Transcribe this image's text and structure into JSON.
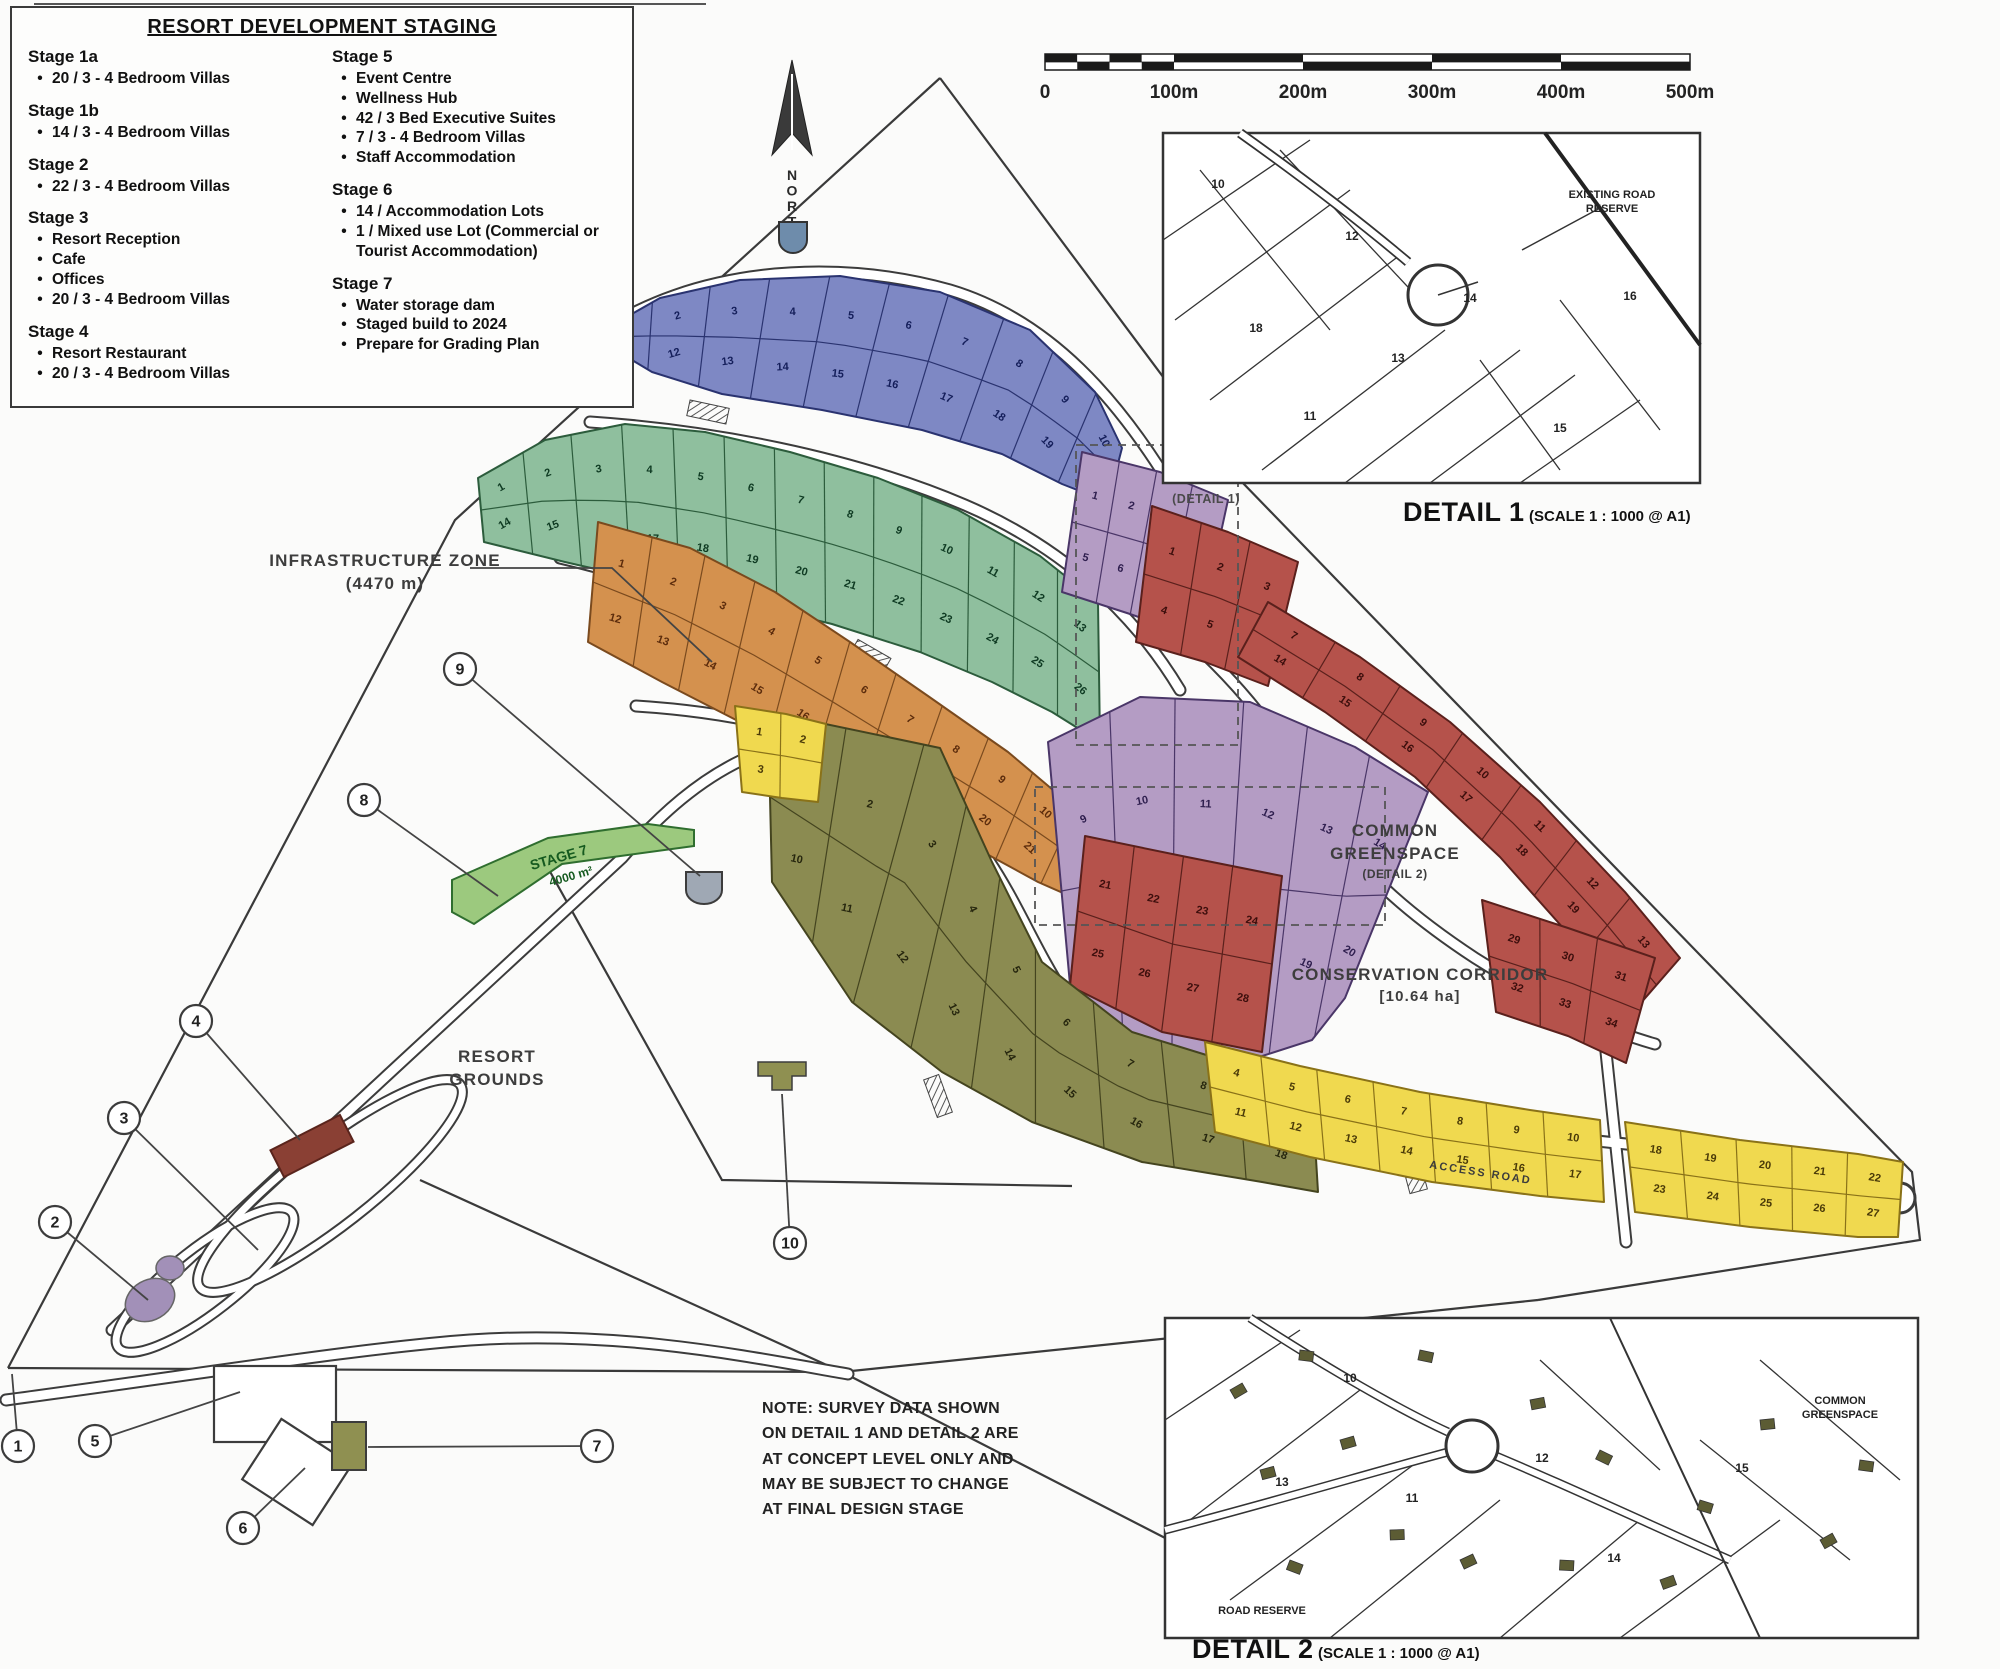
{
  "legend": {
    "title": "RESORT DEVELOPMENT STAGING",
    "columns": [
      [
        {
          "name": "Stage 1a",
          "items": [
            "20 / 3 - 4 Bedroom Villas"
          ]
        },
        {
          "name": "Stage 1b",
          "items": [
            "14 / 3 - 4 Bedroom Villas"
          ]
        },
        {
          "name": "Stage 2",
          "items": [
            "22 / 3 - 4 Bedroom Villas"
          ]
        },
        {
          "name": "Stage 3",
          "items": [
            "Resort Reception",
            "Cafe",
            "Offices",
            "20 / 3 - 4 Bedroom Villas"
          ]
        },
        {
          "name": "Stage 4",
          "items": [
            "Resort Restaurant",
            "20 / 3 - 4 Bedroom Villas"
          ]
        }
      ],
      [
        {
          "name": "Stage 5",
          "items": [
            "Event Centre",
            "Wellness Hub",
            "42 / 3 Bed Executive Suites",
            "7 / 3 - 4 Bedroom Villas",
            "Staff Accommodation"
          ]
        },
        {
          "name": "Stage 6",
          "items": [
            "14 / Accommodation Lots",
            "1 / Mixed use Lot (Commercial or Tourist Accommodation)"
          ]
        },
        {
          "name": "Stage 7",
          "items": [
            "Water storage dam",
            "Staged build to 2024",
            "Prepare for Grading Plan"
          ]
        }
      ]
    ]
  },
  "north": {
    "label": "NORTH"
  },
  "scale_bar": {
    "labels": [
      "0",
      "100m",
      "200m",
      "300m",
      "400m",
      "500m"
    ]
  },
  "map_labels": {
    "infrastructure": {
      "line1": "INFRASTRUCTURE ZONE",
      "line2": "(4470 m)"
    },
    "resort_grounds": {
      "line1": "RESORT",
      "line2": "GROUNDS"
    },
    "common_greenspace": {
      "line1": "COMMON",
      "line2": "GREENSPACE",
      "tag": "(DETAIL 2)"
    },
    "conservation": {
      "line1": "CONSERVATION CORRIDOR",
      "line2": "[10.64 ha]"
    },
    "detail1_tag": "(DETAIL 1)",
    "stage7_strip": {
      "line1": "STAGE 7",
      "line2": "4000 m²"
    },
    "road_name": "ACCESS ROAD"
  },
  "note": {
    "lines": [
      "NOTE: SURVEY DATA SHOWN",
      "ON DETAIL 1 AND DETAIL 2 ARE",
      "AT CONCEPT LEVEL ONLY AND",
      "MAY BE SUBJECT TO CHANGE",
      "AT FINAL DESIGN STAGE"
    ]
  },
  "details": {
    "d1": {
      "caption": "DETAIL 1",
      "scale": "(SCALE 1 : 1000 @ A1)",
      "pointer": {
        "line1": "EXISTING ROAD",
        "line2": "RESERVE"
      },
      "lot_numbers": [
        "10",
        "11",
        "12",
        "13",
        "14",
        "15",
        "16",
        "18"
      ]
    },
    "d2": {
      "caption": "DETAIL 2",
      "scale": "(SCALE 1 : 1000 @ A1)",
      "right_label": {
        "line1": "COMMON",
        "line2": "GREENSPACE"
      },
      "bottom_label": "ROAD RESERVE",
      "lot_numbers": [
        "10",
        "11",
        "12",
        "13",
        "14",
        "15"
      ]
    }
  },
  "callouts": [
    {
      "n": "1",
      "cx": 18,
      "cy": 1446,
      "lx": 12,
      "ly": 1374
    },
    {
      "n": "2",
      "cx": 55,
      "cy": 1222,
      "lx": 148,
      "ly": 1300
    },
    {
      "n": "3",
      "cx": 124,
      "cy": 1118,
      "lx": 258,
      "ly": 1250
    },
    {
      "n": "4",
      "cx": 196,
      "cy": 1021,
      "lx": 300,
      "ly": 1140
    },
    {
      "n": "5",
      "cx": 95,
      "cy": 1441,
      "lx": 240,
      "ly": 1392
    },
    {
      "n": "6",
      "cx": 243,
      "cy": 1528,
      "lx": 305,
      "ly": 1468
    },
    {
      "n": "7",
      "cx": 597,
      "cy": 1446,
      "lx": 368,
      "ly": 1447
    },
    {
      "n": "8",
      "cx": 364,
      "cy": 800,
      "lx": 498,
      "ly": 896
    },
    {
      "n": "9",
      "cx": 460,
      "cy": 669,
      "lx": 700,
      "ly": 876
    },
    {
      "n": "10",
      "cx": 790,
      "cy": 1243,
      "lx": 782,
      "ly": 1094
    }
  ],
  "clusters": [
    {
      "id": "blue",
      "color": "#7e88c4",
      "stroke": "#2a3370",
      "num": "#141e5a",
      "lots": [
        "1",
        "2",
        "3",
        "4",
        "5",
        "6",
        "7",
        "8",
        "9",
        "10",
        "11",
        "12",
        "13",
        "14",
        "15",
        "16",
        "17",
        "18",
        "19",
        "20"
      ]
    },
    {
      "id": "green",
      "color": "#8fbf9e",
      "stroke": "#2c5c3c",
      "num": "#0e3a22",
      "lots": [
        "1",
        "2",
        "3",
        "4",
        "5",
        "6",
        "7",
        "8",
        "9",
        "10",
        "11",
        "12",
        "13",
        "14",
        "15",
        "16",
        "17",
        "18",
        "19",
        "20",
        "21",
        "22",
        "23",
        "24",
        "25",
        "26"
      ]
    },
    {
      "id": "orange",
      "color": "#d4914e",
      "stroke": "#7a4a1e",
      "num": "#5c2c0c",
      "lots": [
        "1",
        "2",
        "3",
        "4",
        "5",
        "6",
        "7",
        "8",
        "9",
        "10",
        "11",
        "12",
        "13",
        "14",
        "15",
        "16",
        "17",
        "18",
        "19",
        "20",
        "21",
        "22"
      ]
    },
    {
      "id": "purple_a",
      "color": "#b49cc4",
      "stroke": "#4a3668",
      "num": "#2e1e4e",
      "lots": [
        "1",
        "2",
        "3",
        "4",
        "5",
        "6",
        "7",
        "8"
      ]
    },
    {
      "id": "purple_b",
      "color": "#b49cc4",
      "stroke": "#4a3668",
      "num": "#2e1e4e",
      "lots": [
        "9",
        "10",
        "11",
        "12",
        "13",
        "14",
        "15",
        "16",
        "17",
        "18",
        "19",
        "20"
      ]
    },
    {
      "id": "red_head",
      "color": "#b5524b",
      "stroke": "#5a201c",
      "num": "#3c0e0c",
      "lots": [
        "1",
        "2",
        "3",
        "4",
        "5",
        "6"
      ]
    },
    {
      "id": "red_band",
      "color": "#b5524b",
      "stroke": "#5a201c",
      "num": "#3c0e0c",
      "lots": [
        "7",
        "8",
        "9",
        "10",
        "11",
        "12",
        "13",
        "14",
        "15",
        "16",
        "17",
        "18",
        "19",
        "20"
      ]
    },
    {
      "id": "red_low",
      "color": "#b5524b",
      "stroke": "#5a201c",
      "num": "#3c0e0c",
      "lots": [
        "21",
        "22",
        "23",
        "24",
        "25",
        "26",
        "27",
        "28"
      ]
    },
    {
      "id": "red_right",
      "color": "#b5524b",
      "stroke": "#5a201c",
      "num": "#3c0e0c",
      "lots": [
        "29",
        "30",
        "31",
        "32",
        "33",
        "34"
      ]
    },
    {
      "id": "olive",
      "color": "#8b8b51",
      "stroke": "#44441f",
      "num": "#26260e",
      "lots": [
        "1",
        "2",
        "3",
        "4",
        "5",
        "6",
        "7",
        "8",
        "9",
        "10",
        "11",
        "12",
        "13",
        "14",
        "15",
        "16",
        "17",
        "18"
      ]
    },
    {
      "id": "yellow_a",
      "color": "#f0d94f",
      "stroke": "#8a7218",
      "num": "#4a3a08",
      "lots": [
        "1",
        "2",
        "3"
      ]
    },
    {
      "id": "yellow_b",
      "color": "#f0d94f",
      "stroke": "#8a7218",
      "num": "#4a3a08",
      "lots": [
        "4",
        "5",
        "6",
        "7",
        "8",
        "9",
        "10",
        "11",
        "12",
        "13",
        "14",
        "15",
        "16",
        "17"
      ]
    },
    {
      "id": "yellow_c",
      "color": "#f0d94f",
      "stroke": "#8a7218",
      "num": "#4a3a08",
      "lots": [
        "18",
        "19",
        "20",
        "21",
        "22",
        "23",
        "24",
        "25",
        "26",
        "27"
      ]
    }
  ],
  "colors": {
    "boundary": "#3a3a3a",
    "road_fill": "#ffffff",
    "stage7_strip": "#9cc97e",
    "building_red": "#8a4034",
    "building_purple": "#a290b8",
    "building_olive": "#8f9051",
    "north_shield": "#6e8cab"
  }
}
